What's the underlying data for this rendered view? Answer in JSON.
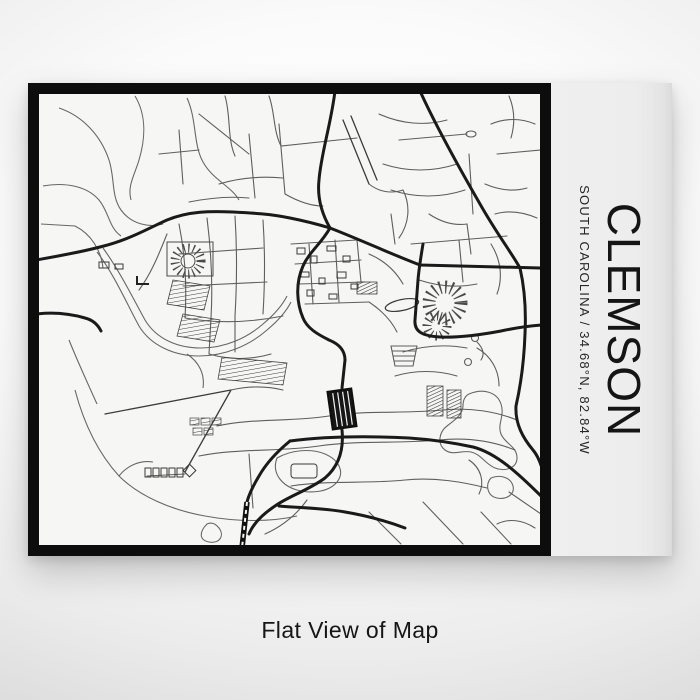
{
  "poster": {
    "title": "CLEMSON",
    "subtitle": "SOUTH CAROLINA / 34.68°N, 82.84°W",
    "map_description": "monochrome street map of Clemson, South Carolina"
  },
  "caption": "Flat View of Map",
  "colors": {
    "ink": "#151515",
    "frame": "#0d0d0d",
    "mapbg": "#f6f6f5",
    "roadmajor": "#1a1a1a",
    "roadmid": "#3c3c3c",
    "roadminor": "#5e5e5e"
  }
}
